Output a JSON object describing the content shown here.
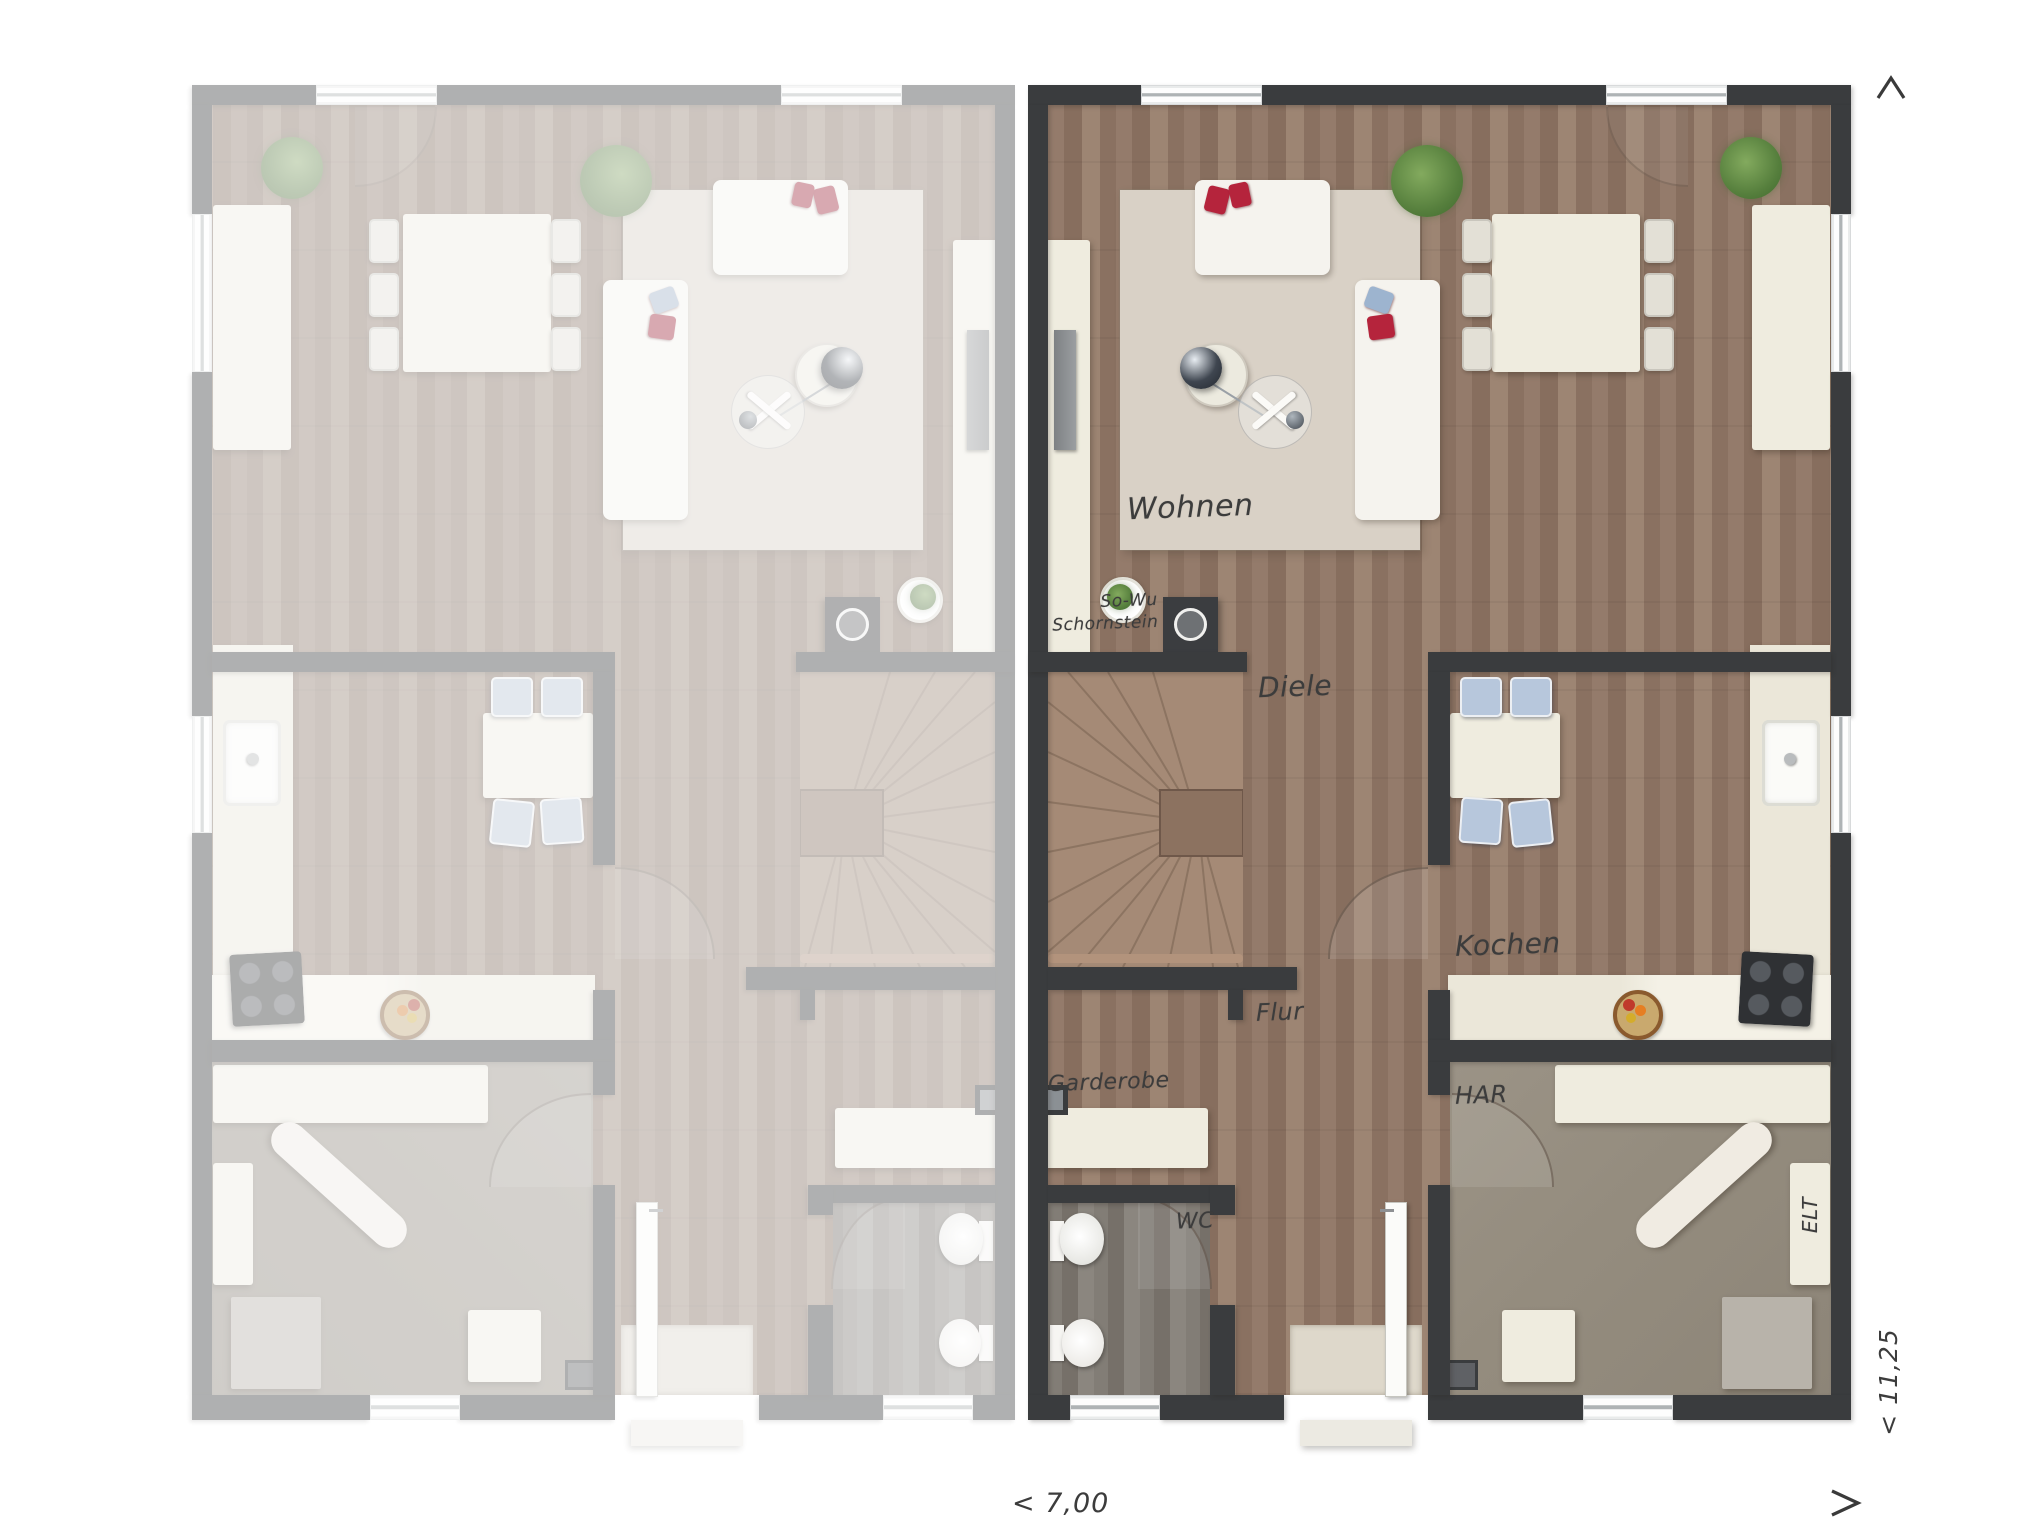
{
  "plan": {
    "title": "Doppelhaus Erdgeschoss Grundriss",
    "labels": {
      "wohnen": "Wohnen",
      "schornstein_line1": "So-Wu",
      "schornstein_line2": "Schornstein",
      "diele": "Diele",
      "kochen": "Kochen",
      "flur": "Flur",
      "garderobe": "Garderobe",
      "wc": "WC",
      "har": "HAR",
      "elt": "ELT"
    },
    "dimensions": {
      "width_label": "< 7,00",
      "depth_label": "< 11,25"
    },
    "colors": {
      "wall": "#3a3c3e",
      "wood_floor": "#8d7466",
      "stair_wood": "#a58a76",
      "rug": "#d9d1c6",
      "furniture_cream": "#efecdf",
      "chair_blue": "#b7c7dc",
      "cushion_red": "#b5243c",
      "wc_floor": "#7e7972",
      "har_floor": "#968e82",
      "label_text": "#3c3c3c",
      "background": "#ffffff"
    }
  }
}
